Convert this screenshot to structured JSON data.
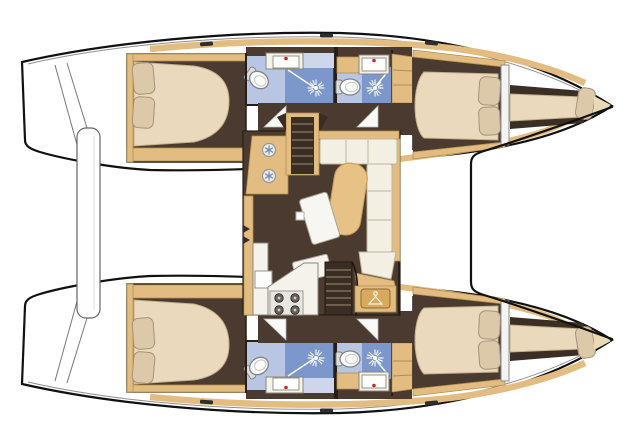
{
  "diagram": {
    "type": "boat-floorplan",
    "vessel": "catamaran",
    "orientation": "bow-right, twin hulls top and bottom, salon amidships"
  },
  "palette": {
    "floor": "#4b3a2f",
    "wall": "#271e15",
    "wood": "#e3bc82",
    "woodEdge": "#b3914f",
    "wood2": "#e7c286",
    "wood2Edge": "#c9974e",
    "woodDeep": "#d9a95f",
    "woodDeepEdge": "#8a6a30",
    "cream": "#ead9bd",
    "creamEdge": "#c4ae8a",
    "pillow": "#dcc9a9",
    "pillowEdge": "#a6927a",
    "cushion": "#f3efe2",
    "cushionEdge": "#bdb49e",
    "blueLight": "#b9c6e3",
    "blueMid": "#7b97cc",
    "bluePale": "#cdd6ea",
    "blueIcon": "#7488ae",
    "white": "#ffffff",
    "counter": "#f4f2ea",
    "outline": "#111111",
    "gray": "#8f8f8f",
    "tread": "#8d7a64",
    "stairDark": "#3a2d23",
    "red": "#c62828",
    "toiletEdge": "#80848a"
  },
  "features": {
    "salon": [
      "fridge-drawers-with-snowflake-icons",
      "companionway-stairs-port",
      "companionway-stairs-starboard",
      "l-shaped-sofa",
      "curved-bench",
      "salon-table",
      "galley-counter",
      "four-burner-stove",
      "galley-sink",
      "wardrobe-with-hanger-icon"
    ],
    "port_hull": [
      "stern-transom-steps",
      "aft-cabin-double-bed",
      "aft-head-toilet-sink-shower",
      "forward-head-toilet-sink-shower",
      "forward-cabin-double-bed",
      "bow-single-berth"
    ],
    "starboard_hull": [
      "stern-transom-steps",
      "aft-cabin-double-bed",
      "aft-head-toilet-sink-shower",
      "forward-head-toilet-sink-shower",
      "forward-cabin-double-bed",
      "bow-single-berth"
    ],
    "between_hulls": [
      "stern-platform",
      "foredeck-panel"
    ]
  },
  "icons": {
    "shower": "white-spray-starburst",
    "fridge": "snowflake-circle",
    "wardrobe": "clothes-hanger",
    "faucet": "red-dot"
  }
}
